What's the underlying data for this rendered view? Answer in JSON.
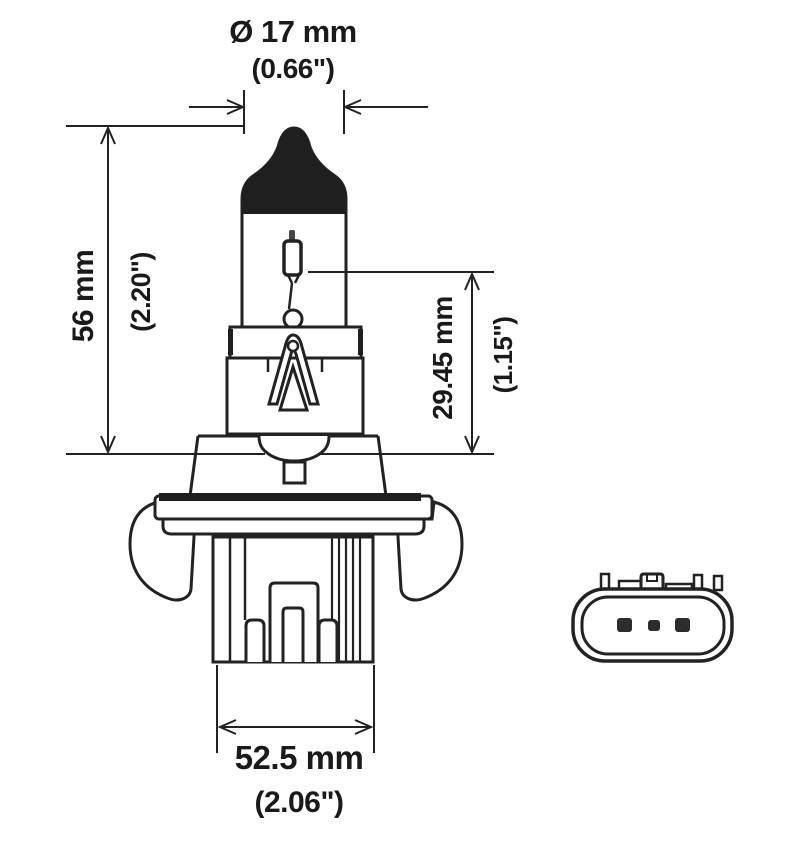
{
  "diagram": {
    "title": "halogen-bulb-technical-drawing",
    "background_color": "#ffffff",
    "line_color": "#222222",
    "text_color": "#1a1a1a",
    "dimensions": {
      "diameter": {
        "metric": "Ø 17 mm",
        "imperial": "(0.66\")"
      },
      "height": {
        "metric": "56 mm",
        "imperial": "(2.20\")"
      },
      "light_center_length": {
        "metric": "29.45 mm",
        "imperial": "(1.15\")"
      },
      "base_width": {
        "metric": "52.5 mm",
        "imperial": "(2.06\")"
      }
    }
  }
}
